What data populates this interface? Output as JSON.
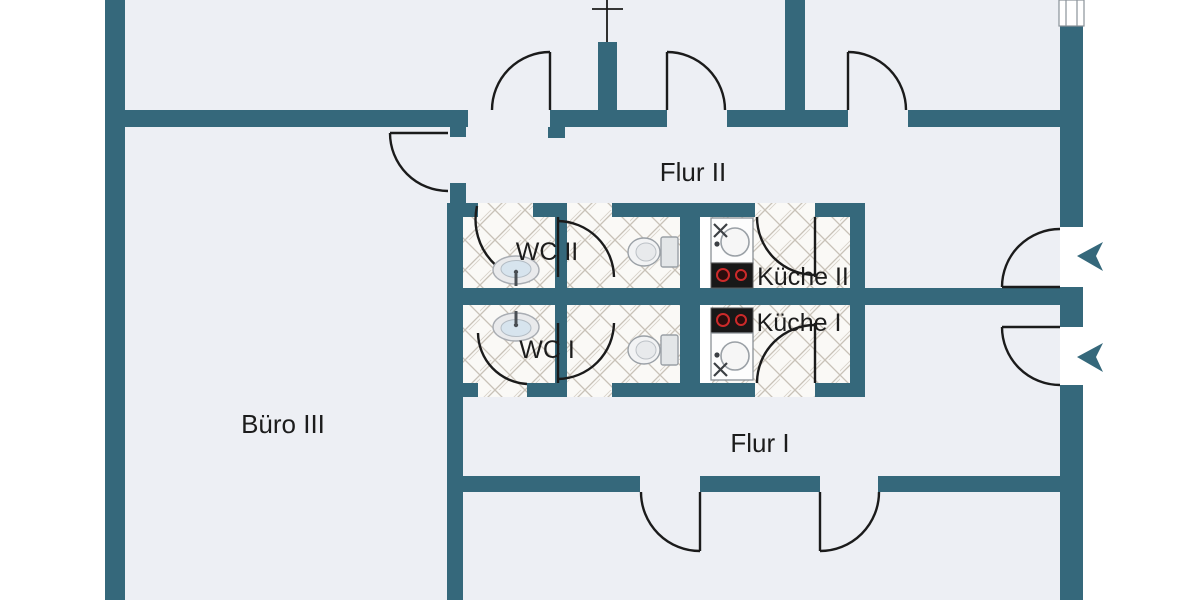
{
  "floorplan": {
    "type": "architectural-floor-plan",
    "language": "de",
    "rooms": {
      "flur_ii": {
        "label": "Flur II"
      },
      "wc_ii": {
        "label": "WC II"
      },
      "kueche_ii": {
        "label": "Küche II"
      },
      "kueche_i": {
        "label": "Küche I"
      },
      "wc_i": {
        "label": "WC I"
      },
      "buero_iii": {
        "label": "Büro III"
      },
      "flur_i": {
        "label": "Flur I"
      }
    },
    "colors": {
      "wall": "#35687b",
      "floor": "#edeff4",
      "outside": "#ffffff",
      "door_line": "#1b1b1b",
      "tile_background": "#faf9f6",
      "tile_line": "#c9c2b8",
      "stove_body": "#181818",
      "burner_ring": "#cc2a2a",
      "label_text": "#1c1c1c"
    },
    "icons": {
      "door_swings": 13,
      "entrance_arrows": 2,
      "windows": 1,
      "toilets": 2,
      "wc_sinks": 2,
      "kitchen_units": 2
    }
  }
}
